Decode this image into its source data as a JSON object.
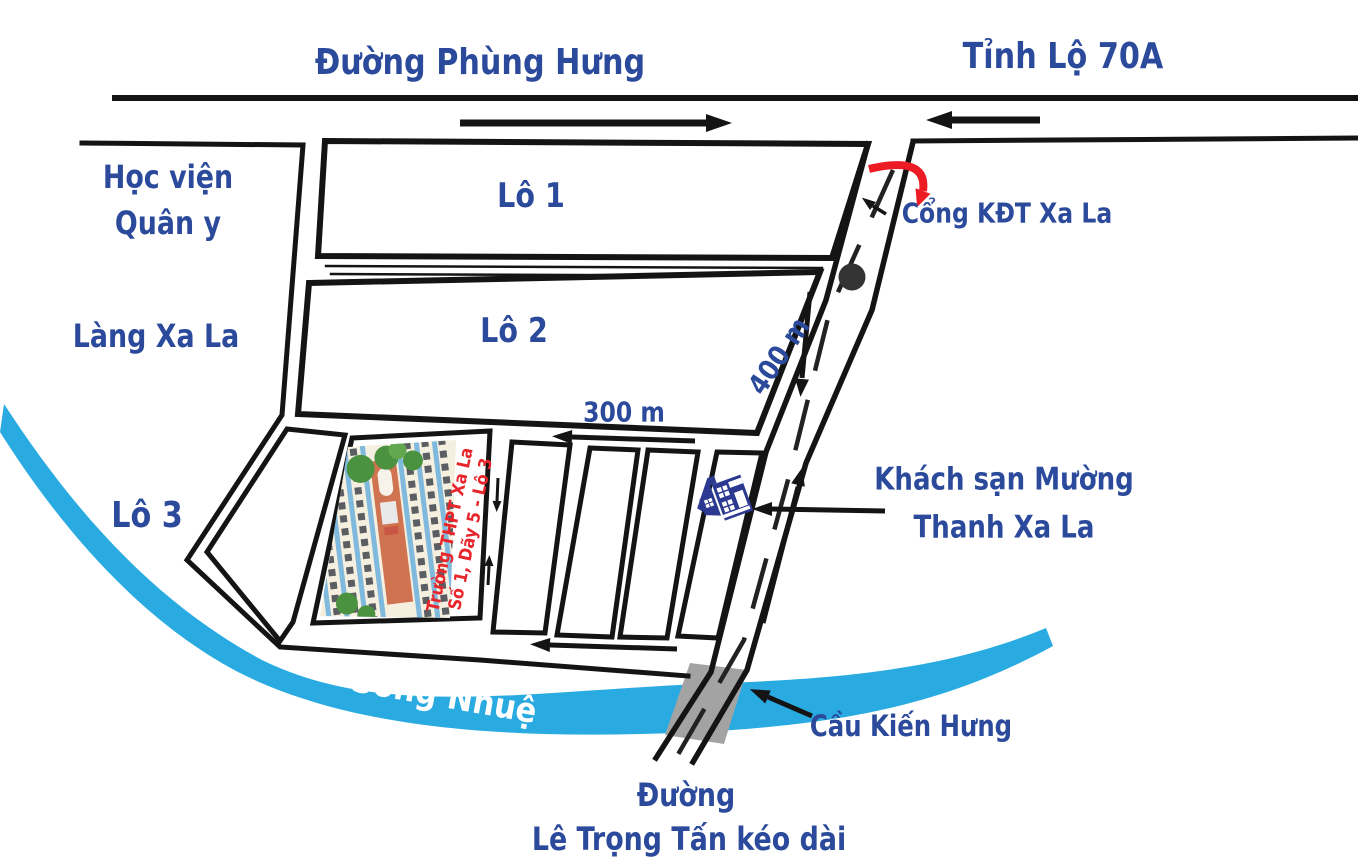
{
  "map": {
    "labels": {
      "duong_phung_hung": "Đường Phùng Hưng",
      "tinh_lo_70a": "Tỉnh Lộ 70A",
      "hoc_vien_line1": "Học viện",
      "hoc_vien_line2": "Quân y",
      "lang_xa_la": "Làng Xa La",
      "lo_1": "Lô 1",
      "lo_2": "Lô 2",
      "lo_3": "Lô 3",
      "cong_kdt": "Cổng KĐT Xa La",
      "dist_400": "400 m",
      "dist_300": "300 m",
      "khach_san_line1": "Khách sạn Mường",
      "khach_san_line2": "Thanh Xa La",
      "school_line1": "Trường THPT Xa La",
      "school_line2": "Số 1, Dãy 5 - Lô 3",
      "song_nhue": "Sông Nhuệ",
      "cau_kien_hung": "Cầu Kiến Hưng",
      "duong_bottom": "Đường",
      "le_trong_tan": "Lê Trọng Tấn kéo dài"
    },
    "colors": {
      "label_blue": "#2B4A9B",
      "river_blue": "#29ABE2",
      "accent_red": "#ED1C24",
      "school_text_red": "#E8252B",
      "hotel_navy": "#2B3990",
      "bridge_gray": "#A3A3A3",
      "road_black": "#141414",
      "river_text_white": "#FFFFFF"
    }
  }
}
